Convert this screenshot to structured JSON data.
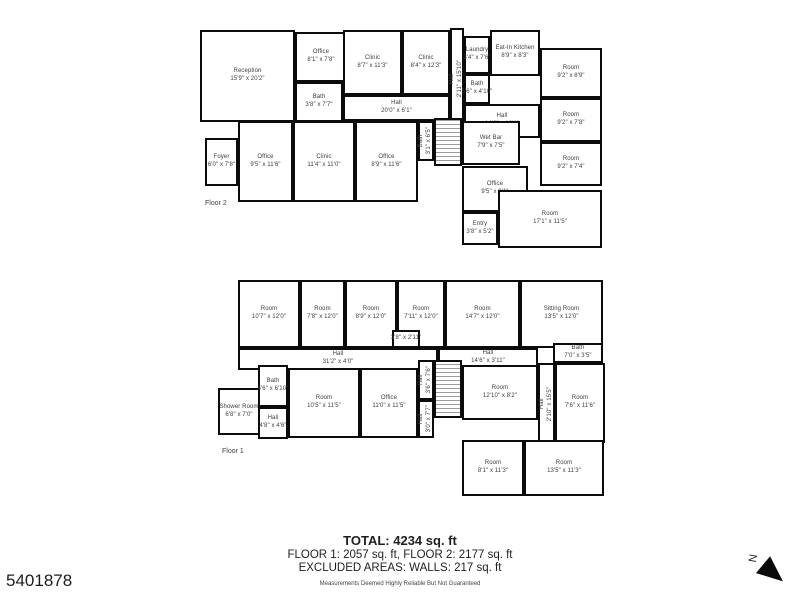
{
  "colors": {
    "wall": "#0b0b0b",
    "label_text": "#3c3c3c",
    "background": "#ffffff"
  },
  "summary": {
    "total": "TOTAL: 4234 sq. ft",
    "floors_line": "FLOOR 1: 2057 sq. ft, FLOOR 2: 2177 sq. ft",
    "excluded": "EXCLUDED AREAS: WALLS: 217 sq. ft",
    "disclaimer": "Measurements Deemed Highly Reliable But Not Guaranteed"
  },
  "mls_number": "5401878",
  "compass": {
    "label": "N"
  },
  "floors": [
    {
      "name": "Floor 2",
      "label_pos": {
        "x": 205,
        "y": 200
      },
      "rooms": [
        {
          "id": "reception",
          "name": "Reception",
          "dims": "15'9\" x 20'2\"",
          "x": 200,
          "y": 30,
          "w": 95,
          "h": 92
        },
        {
          "id": "office-top",
          "name": "Office",
          "dims": "8'1\" x 7'8\"",
          "x": 295,
          "y": 32,
          "w": 52,
          "h": 50
        },
        {
          "id": "bath-small",
          "name": "Bath",
          "dims": "3'8\" x 7'7\"",
          "x": 295,
          "y": 82,
          "w": 48,
          "h": 40
        },
        {
          "id": "clinic-1",
          "name": "Clinic",
          "dims": "8'7\" x 11'3\"",
          "x": 343,
          "y": 30,
          "w": 59,
          "h": 65
        },
        {
          "id": "clinic-2",
          "name": "Clinic",
          "dims": "8'4\" x 12'3\"",
          "x": 402,
          "y": 30,
          "w": 48,
          "h": 65
        },
        {
          "id": "hall-vertical",
          "name": "Hall",
          "dims": "2'11\" x 15'10\"",
          "x": 450,
          "y": 28,
          "w": 14,
          "h": 102,
          "vertical": true
        },
        {
          "id": "laundry",
          "name": "Laundry",
          "dims": "3'4\" x 7'6\"",
          "x": 464,
          "y": 36,
          "w": 26,
          "h": 38
        },
        {
          "id": "eat-in-kitchen",
          "name": "Eat-In Kitchen",
          "dims": "8'9\" x 8'3\"",
          "x": 490,
          "y": 30,
          "w": 50,
          "h": 46
        },
        {
          "id": "bath-kitchen",
          "name": "Bath",
          "dims": "5'6\" x 4'10\"",
          "x": 464,
          "y": 74,
          "w": 26,
          "h": 30
        },
        {
          "id": "hall-upper-right",
          "name": "Hall",
          "dims": "14'6\" x 10'1\"",
          "x": 464,
          "y": 104,
          "w": 76,
          "h": 34
        },
        {
          "id": "room-ne-1",
          "name": "Room",
          "dims": "9'2\" x 8'9\"",
          "x": 540,
          "y": 48,
          "w": 62,
          "h": 50
        },
        {
          "id": "room-ne-2",
          "name": "Room",
          "dims": "9'2\" x 7'8\"",
          "x": 540,
          "y": 98,
          "w": 62,
          "h": 44
        },
        {
          "id": "room-ne-3",
          "name": "Room",
          "dims": "9'2\" x 7'4\"",
          "x": 540,
          "y": 142,
          "w": 62,
          "h": 44
        },
        {
          "id": "hall-long",
          "name": "Hall",
          "dims": "20'0\" x 6'1\"",
          "x": 343,
          "y": 95,
          "w": 107,
          "h": 26
        },
        {
          "id": "foyer",
          "name": "Foyer",
          "dims": "6'0\" x 7'8\"",
          "x": 205,
          "y": 138,
          "w": 33,
          "h": 48
        },
        {
          "id": "office-mid-1",
          "name": "Office",
          "dims": "9'5\" x 11'6\"",
          "x": 238,
          "y": 121,
          "w": 55,
          "h": 81
        },
        {
          "id": "clinic-3",
          "name": "Clinic",
          "dims": "11'4\" x 11'0\"",
          "x": 293,
          "y": 121,
          "w": 62,
          "h": 81
        },
        {
          "id": "office-mid-2",
          "name": "Office",
          "dims": "8'9\" x 11'6\"",
          "x": 355,
          "y": 121,
          "w": 63,
          "h": 81
        },
        {
          "id": "bath-stair",
          "name": "Bath",
          "dims": "3'1\" x 6'5\"",
          "x": 418,
          "y": 121,
          "w": 16,
          "h": 40,
          "vertical": true
        },
        {
          "id": "stairs",
          "x": 434,
          "y": 118,
          "w": 28,
          "h": 48,
          "hatch": true
        },
        {
          "id": "wet-bar",
          "name": "Wet Bar",
          "dims": "7'9\" x 7'5\"",
          "x": 462,
          "y": 121,
          "w": 58,
          "h": 44
        },
        {
          "id": "office-lower",
          "name": "Office",
          "dims": "9'5\" x 9'1\"",
          "x": 462,
          "y": 166,
          "w": 66,
          "h": 46
        },
        {
          "id": "entry",
          "name": "Entry",
          "dims": "3'8\" x 5'2\"",
          "x": 462,
          "y": 212,
          "w": 36,
          "h": 33
        },
        {
          "id": "room-se",
          "name": "Room",
          "dims": "17'1\" x 11'5\"",
          "x": 498,
          "y": 190,
          "w": 104,
          "h": 58
        }
      ]
    },
    {
      "name": "Floor 1",
      "label_pos": {
        "x": 222,
        "y": 448
      },
      "rooms": [
        {
          "id": "room-1",
          "name": "Room",
          "dims": "10'7\" x 12'0\"",
          "x": 238,
          "y": 280,
          "w": 62,
          "h": 68
        },
        {
          "id": "room-2",
          "name": "Room",
          "dims": "7'8\" x 12'0\"",
          "x": 300,
          "y": 280,
          "w": 45,
          "h": 68
        },
        {
          "id": "room-3",
          "name": "Room",
          "dims": "8'9\" x 12'0\"",
          "x": 345,
          "y": 280,
          "w": 52,
          "h": 68
        },
        {
          "id": "room-4",
          "name": "Room",
          "dims": "7'11\" x 12'0\"",
          "x": 397,
          "y": 280,
          "w": 48,
          "h": 68
        },
        {
          "id": "room-5",
          "name": "Room",
          "dims": "14'7\" x 12'0\"",
          "x": 445,
          "y": 280,
          "w": 75,
          "h": 68
        },
        {
          "id": "sitting-room",
          "name": "Sitting Room",
          "dims": "13'5\" x 12'0\"",
          "x": 520,
          "y": 280,
          "w": 83,
          "h": 68
        },
        {
          "id": "closet",
          "dims": "3'8\" x 2'11\"",
          "x": 392,
          "y": 330,
          "w": 28,
          "h": 18
        },
        {
          "id": "hall-main",
          "name": "Hall",
          "dims": "31'2\" x 4'0\"",
          "x": 238,
          "y": 348,
          "w": 200,
          "h": 22
        },
        {
          "id": "hall-right",
          "name": "Hall",
          "dims": "14'6\" x 3'11\"",
          "x": 438,
          "y": 348,
          "w": 100,
          "h": 20
        },
        {
          "id": "bath-top-right",
          "name": "Bath",
          "dims": "7'0\" x 3'5\"",
          "x": 553,
          "y": 343,
          "w": 50,
          "h": 20
        },
        {
          "id": "hall-vertical-right",
          "name": "Hall",
          "dims": "2'10\" x 15'5\"",
          "x": 538,
          "y": 363,
          "w": 17,
          "h": 82,
          "vertical": true
        },
        {
          "id": "shower-room",
          "name": "Shower Room",
          "dims": "6'8\" x 7'0\"",
          "x": 218,
          "y": 388,
          "w": 42,
          "h": 47
        },
        {
          "id": "bath-lower",
          "name": "Bath",
          "dims": "4'6\" x 6'10\"",
          "x": 258,
          "y": 365,
          "w": 30,
          "h": 42
        },
        {
          "id": "hall-small",
          "name": "Hall",
          "dims": "4'8\" x 4'6\"",
          "x": 258,
          "y": 407,
          "w": 30,
          "h": 32
        },
        {
          "id": "room-6",
          "name": "Room",
          "dims": "10'5\" x 11'5\"",
          "x": 288,
          "y": 368,
          "w": 72,
          "h": 70
        },
        {
          "id": "office-f1",
          "name": "Office",
          "dims": "11'0\" x 11'5\"",
          "x": 360,
          "y": 368,
          "w": 58,
          "h": 70
        },
        {
          "id": "hall-stair-1",
          "name": "Hall",
          "dims": "3'6\" x 7'6\"",
          "x": 418,
          "y": 360,
          "w": 16,
          "h": 40,
          "vertical": true
        },
        {
          "id": "hall-stair-2",
          "name": "Hall",
          "dims": "3'0\" x 7'7\"",
          "x": 418,
          "y": 400,
          "w": 16,
          "h": 38,
          "vertical": true
        },
        {
          "id": "stairs",
          "x": 434,
          "y": 360,
          "w": 28,
          "h": 58,
          "hatch": true
        },
        {
          "id": "room-7",
          "name": "Room",
          "dims": "12'10\" x 8'2\"",
          "x": 462,
          "y": 365,
          "w": 76,
          "h": 55
        },
        {
          "id": "room-8",
          "name": "Room",
          "dims": "7'6\" x 11'6\"",
          "x": 555,
          "y": 363,
          "w": 50,
          "h": 80
        },
        {
          "id": "room-9",
          "name": "Room",
          "dims": "8'1\" x 11'3\"",
          "x": 462,
          "y": 440,
          "w": 62,
          "h": 56
        },
        {
          "id": "room-10",
          "name": "Room",
          "dims": "13'5\" x 11'3\"",
          "x": 524,
          "y": 440,
          "w": 80,
          "h": 56
        }
      ]
    }
  ]
}
